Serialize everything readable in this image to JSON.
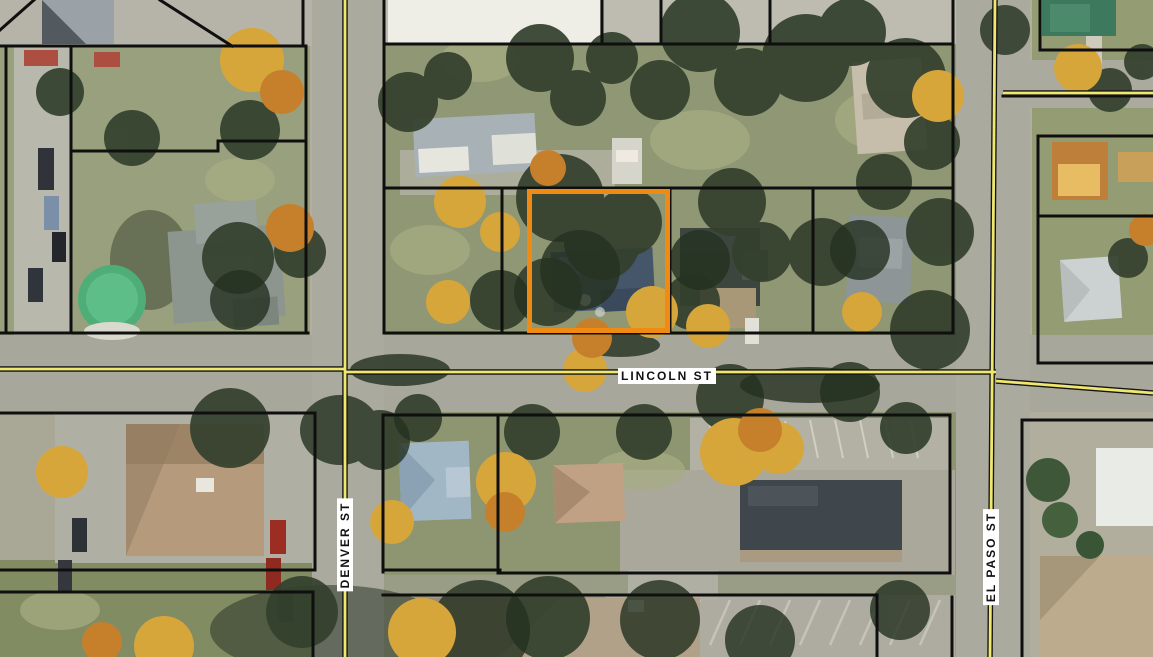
{
  "map": {
    "type": "aerial-parcel-map",
    "streets": {
      "lincoln": {
        "label": "LINCOLN ST",
        "orientation": "horizontal"
      },
      "denver": {
        "label": "DENVER ST",
        "orientation": "vertical"
      },
      "el_paso": {
        "label": "EL PASO ST",
        "orientation": "vertical"
      }
    },
    "selected_parcel": {
      "highlight_color": "#EF8B13"
    },
    "colors": {
      "parcel_line": "#0F0F0F",
      "road_centerline_yellow": "#EFE76E",
      "road_surface": "#A8A79C",
      "street_label_bg": "#FFFFFF",
      "street_label_text": "#111111"
    }
  }
}
